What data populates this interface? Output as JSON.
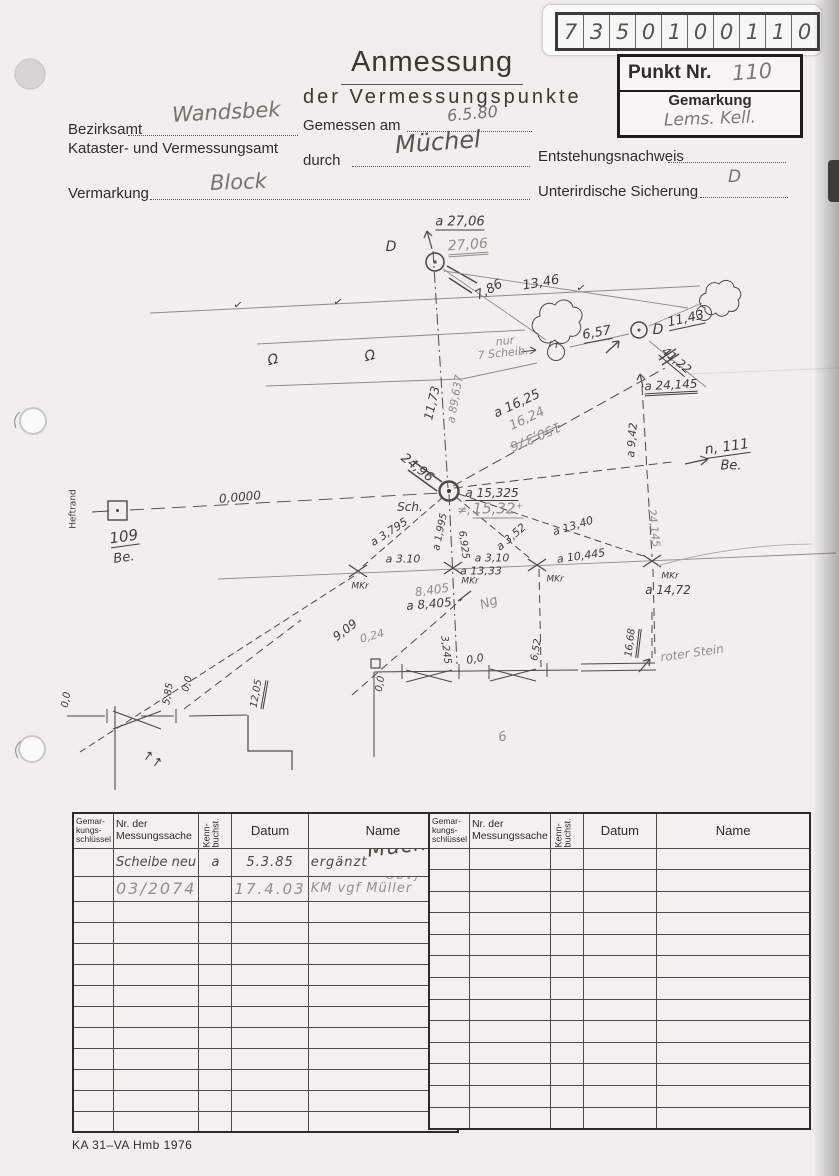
{
  "code_box": {
    "digits": [
      "7",
      "3",
      "5",
      "0",
      "1",
      "0",
      "0",
      "1",
      "1",
      "0"
    ]
  },
  "point_box": {
    "punkt_label": "Punkt Nr.",
    "punkt_value": "110",
    "gemarkung_label": "Gemarkung",
    "gemarkung_value": "Lems. Kell."
  },
  "header": {
    "title": "Anmessung",
    "subtitle": "der Vermessungspunkte"
  },
  "form": {
    "bezirksamt_label": "Bezirksamt",
    "bezirksamt_value": "Wandsbek",
    "amt_label": "Kataster- und Vermessungsamt",
    "gemessen_label": "Gemessen am",
    "gemessen_value": "6.5.80",
    "durch_label": "durch",
    "durch_value": "Müchel",
    "entstehung_label": "Entstehungsnachweis",
    "entstehung_value": "",
    "vermarkung_label": "Vermarkung",
    "vermarkung_value": "Block",
    "sicherung_label": "Unterirdische Sicherung",
    "sicherung_value": "D"
  },
  "sketch": {
    "labels": [
      {
        "t": "a 27,06",
        "x": 460,
        "y": 223,
        "r": 0,
        "s": "ink u",
        "f": 13
      },
      {
        "t": "27,06",
        "x": 468,
        "y": 247,
        "r": -4,
        "s": "pencil u2",
        "f": 14
      },
      {
        "t": "D",
        "x": 391,
        "y": 247,
        "r": 0,
        "s": "ink",
        "f": 14
      },
      {
        "t": "13,46",
        "x": 541,
        "y": 283,
        "r": -10,
        "s": "ink",
        "f": 13
      },
      {
        "t": "7,86",
        "x": 489,
        "y": 290,
        "r": -28,
        "s": "ink",
        "f": 13
      },
      {
        "t": "✓",
        "x": 238,
        "y": 305,
        "r": 10,
        "s": "ink",
        "f": 11
      },
      {
        "t": "✓",
        "x": 338,
        "y": 302,
        "r": 10,
        "s": "ink",
        "f": 11
      },
      {
        "t": "✓",
        "x": 581,
        "y": 288,
        "r": 10,
        "s": "ink",
        "f": 11
      },
      {
        "t": "Ω",
        "x": 273,
        "y": 360,
        "r": -15,
        "s": "ink",
        "f": 14
      },
      {
        "t": "Ω",
        "x": 370,
        "y": 356,
        "r": -15,
        "s": "ink",
        "f": 14
      },
      {
        "t": "nur",
        "x": 505,
        "y": 341,
        "r": -6,
        "s": "pencil",
        "f": 11
      },
      {
        "t": "7 Scheib.",
        "x": 503,
        "y": 353,
        "r": -6,
        "s": "pencil",
        "f": 11
      },
      {
        "t": "6,57",
        "x": 597,
        "y": 334,
        "r": -10,
        "s": "ink u",
        "f": 13
      },
      {
        "t": "D",
        "x": 658,
        "y": 330,
        "r": 0,
        "s": "ink",
        "f": 14
      },
      {
        "t": "11,43",
        "x": 686,
        "y": 320,
        "r": -12,
        "s": "ink u",
        "f": 13
      },
      {
        "t": "41,22",
        "x": 676,
        "y": 361,
        "r": 40,
        "s": "ink u",
        "f": 12
      },
      {
        "t": "a 24,145",
        "x": 671,
        "y": 387,
        "r": -3,
        "s": "ink u2",
        "f": 12
      },
      {
        "t": "a 9,42",
        "x": 632,
        "y": 440,
        "r": -85,
        "s": "ink",
        "f": 11
      },
      {
        "t": "n, 111",
        "x": 727,
        "y": 448,
        "r": -8,
        "s": "ink u",
        "f": 14
      },
      {
        "t": "Be.",
        "x": 731,
        "y": 466,
        "r": 0,
        "s": "ink",
        "f": 13
      },
      {
        "t": "11,73",
        "x": 432,
        "y": 403,
        "r": -77,
        "s": "ink",
        "f": 12
      },
      {
        "t": "a 89,637",
        "x": 455,
        "y": 399,
        "r": -80,
        "s": "pencil",
        "f": 11
      },
      {
        "t": "a 16,25",
        "x": 517,
        "y": 404,
        "r": -25,
        "s": "ink",
        "f": 13
      },
      {
        "t": "16,24",
        "x": 527,
        "y": 419,
        "r": -25,
        "s": "pencil",
        "f": 13
      },
      {
        "t": "150,376",
        "x": 535,
        "y": 436,
        "r": 157,
        "s": "pencil strike",
        "f": 13
      },
      {
        "t": "24,96",
        "x": 417,
        "y": 468,
        "r": 38,
        "s": "ink",
        "f": 13
      },
      {
        "t": "0,0000",
        "x": 240,
        "y": 497,
        "r": -5,
        "s": "ink",
        "f": 12
      },
      {
        "t": "Heftrand",
        "x": 74,
        "y": 509,
        "r": -90,
        "s": "print",
        "f": 9
      },
      {
        "t": "109",
        "x": 124,
        "y": 538,
        "r": -8,
        "s": "ink u",
        "f": 15
      },
      {
        "t": "Be.",
        "x": 124,
        "y": 558,
        "r": -8,
        "s": "ink",
        "f": 13
      },
      {
        "t": "Sch.",
        "x": 410,
        "y": 507,
        "r": 0,
        "s": "ink",
        "f": 12
      },
      {
        "t": "a 15,325",
        "x": 492,
        "y": 494,
        "r": 0,
        "s": "ink u",
        "f": 12
      },
      {
        "t": "≠,",
        "x": 464,
        "y": 510,
        "r": 0,
        "s": "pencil",
        "f": 12
      },
      {
        "t": "15,32⁺",
        "x": 498,
        "y": 510,
        "r": 0,
        "s": "pencil u",
        "f": 15
      },
      {
        "t": "a 13,40",
        "x": 573,
        "y": 526,
        "r": -17,
        "s": "ink",
        "f": 11
      },
      {
        "t": "a 3,52",
        "x": 511,
        "y": 537,
        "r": -40,
        "s": "ink",
        "f": 11
      },
      {
        "t": "a 3,795",
        "x": 389,
        "y": 532,
        "r": -33,
        "s": "ink",
        "f": 11
      },
      {
        "t": "a 1,995",
        "x": 441,
        "y": 532,
        "r": -78,
        "s": "ink",
        "f": 10
      },
      {
        "t": "6,925",
        "x": 463,
        "y": 545,
        "r": 82,
        "s": "ink",
        "f": 10
      },
      {
        "t": "a 3.10",
        "x": 403,
        "y": 559,
        "r": 0,
        "s": "ink",
        "f": 11
      },
      {
        "t": "a 3,10",
        "x": 492,
        "y": 558,
        "r": 0,
        "s": "ink",
        "f": 11
      },
      {
        "t": "a 13,33",
        "x": 481,
        "y": 571,
        "r": 0,
        "s": "ink",
        "f": 11
      },
      {
        "t": "MKr",
        "x": 360,
        "y": 587,
        "r": 0,
        "s": "ink",
        "f": 9
      },
      {
        "t": "MKr",
        "x": 470,
        "y": 582,
        "r": 0,
        "s": "ink",
        "f": 9
      },
      {
        "t": "MKr",
        "x": 555,
        "y": 580,
        "r": 0,
        "s": "ink",
        "f": 9
      },
      {
        "t": "MKr",
        "x": 670,
        "y": 577,
        "r": 0,
        "s": "ink",
        "f": 9
      },
      {
        "t": "a 10,445",
        "x": 581,
        "y": 556,
        "r": -8,
        "s": "ink",
        "f": 11
      },
      {
        "t": "a 14,72",
        "x": 668,
        "y": 590,
        "r": 0,
        "s": "ink",
        "f": 12
      },
      {
        "t": "24,145",
        "x": 654,
        "y": 528,
        "r": 83,
        "s": "pencil",
        "f": 11
      },
      {
        "t": "8,405",
        "x": 432,
        "y": 590,
        "r": -8,
        "s": "pencil",
        "f": 12
      },
      {
        "t": "a 8,405",
        "x": 429,
        "y": 604,
        "r": -5,
        "s": "ink",
        "f": 12
      },
      {
        "t": "Ng",
        "x": 489,
        "y": 603,
        "r": -20,
        "s": "pencil",
        "f": 13
      },
      {
        "t": "9,09",
        "x": 345,
        "y": 630,
        "r": -37,
        "s": "ink",
        "f": 12
      },
      {
        "t": "0,24",
        "x": 372,
        "y": 636,
        "r": -15,
        "s": "pencil",
        "f": 11
      },
      {
        "t": "3,245",
        "x": 445,
        "y": 650,
        "r": 83,
        "s": "ink",
        "f": 10
      },
      {
        "t": "0,0",
        "x": 475,
        "y": 659,
        "r": -10,
        "s": "ink",
        "f": 11
      },
      {
        "t": "6,52",
        "x": 537,
        "y": 650,
        "r": -80,
        "s": "ink",
        "f": 10
      },
      {
        "t": "16,68",
        "x": 633,
        "y": 643,
        "r": -83,
        "s": "ink u2",
        "f": 10
      },
      {
        "t": "roter Stein",
        "x": 692,
        "y": 653,
        "r": -8,
        "s": "pencil",
        "f": 12
      },
      {
        "t": "0,0",
        "x": 381,
        "y": 684,
        "r": -80,
        "s": "ink",
        "f": 10
      },
      {
        "t": "0,0",
        "x": 67,
        "y": 700,
        "r": -80,
        "s": "ink",
        "f": 10
      },
      {
        "t": "5,85",
        "x": 169,
        "y": 694,
        "r": -80,
        "s": "ink",
        "f": 10
      },
      {
        "t": "0,0",
        "x": 188,
        "y": 684,
        "r": -75,
        "s": "ink",
        "f": 10
      },
      {
        "t": "12,05",
        "x": 259,
        "y": 694,
        "r": -80,
        "s": "ink u2",
        "f": 10
      },
      {
        "t": "↑↑",
        "x": 152,
        "y": 760,
        "r": 35,
        "s": "ink",
        "f": 13
      },
      {
        "t": "9",
        "x": 502,
        "y": 735,
        "r": 165,
        "s": "pencil",
        "f": 13
      }
    ]
  },
  "table": {
    "headers": {
      "gem": "Gemar-\nkungs-\nschlüssel",
      "nr": "Nr. der\nMessungssache",
      "kenn": "Kenn-\nbuchst.",
      "datum": "Datum",
      "name": "Name"
    },
    "left_rows": [
      {
        "gem": "",
        "nr": "Scheibe neu",
        "kenn": "a",
        "datum": "5.3.85",
        "name": "ergänzt",
        "sig": "Müchel",
        "note": "",
        "cls": "hw"
      },
      {
        "gem": "",
        "nr": "03/2074",
        "kenn": "",
        "datum": "17.4.03",
        "name": "KM vgf Müller",
        "sig": "",
        "note": "ÖbVJ",
        "cls": "hw-pencil"
      }
    ],
    "empty_rows_left": 11,
    "empty_rows_right": 13
  },
  "footer": {
    "text": "KA 31–VA Hmb 1976"
  }
}
